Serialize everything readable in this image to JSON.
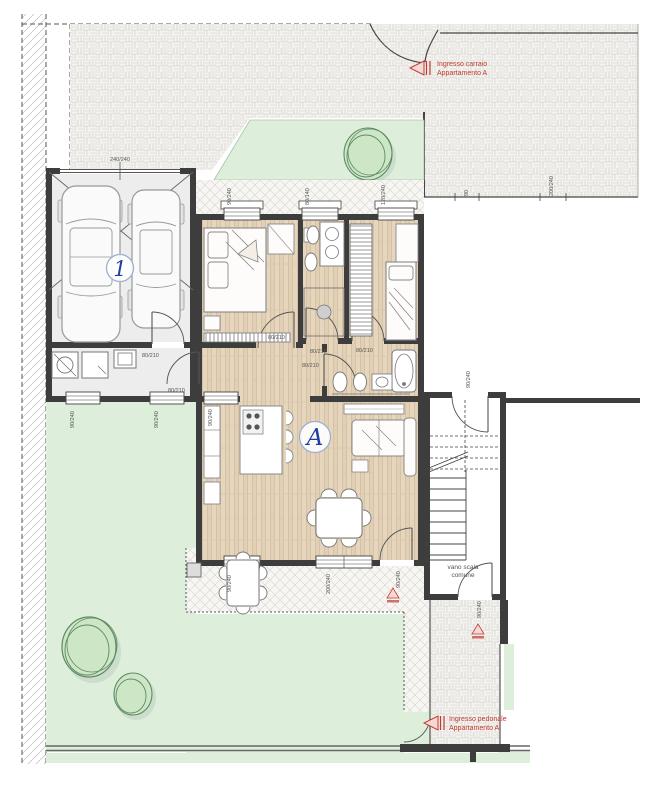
{
  "plan_labels": {
    "apartment_letter": "A",
    "garage_number": "1",
    "stairwell_line1": "vano scala",
    "stairwell_line2": "comune",
    "driveway_entrance_line1": "Ingresso carraio",
    "driveway_entrance_line2": "Appartamento A",
    "pedestrian_entrance_line1": "Ingresso pedonale",
    "pedestrian_entrance_line2": "Appartamento A"
  },
  "dimensions": {
    "interior_door": "80/210",
    "window_90": "90/240",
    "window_small": "80/140",
    "window_large": "120/240",
    "french_window": "200/240",
    "garage_door": "240/240",
    "boundary_width": "90"
  },
  "colors": {
    "entrance_accent": "#c23b2e",
    "label_blue": "#1f3da6",
    "garden_green": "#ddefdb",
    "tree_green": "#cde7c6",
    "wood_floor": "#e2d0b6",
    "wall": "#3d3d3d",
    "paving_gray": "#f4f3f0"
  }
}
